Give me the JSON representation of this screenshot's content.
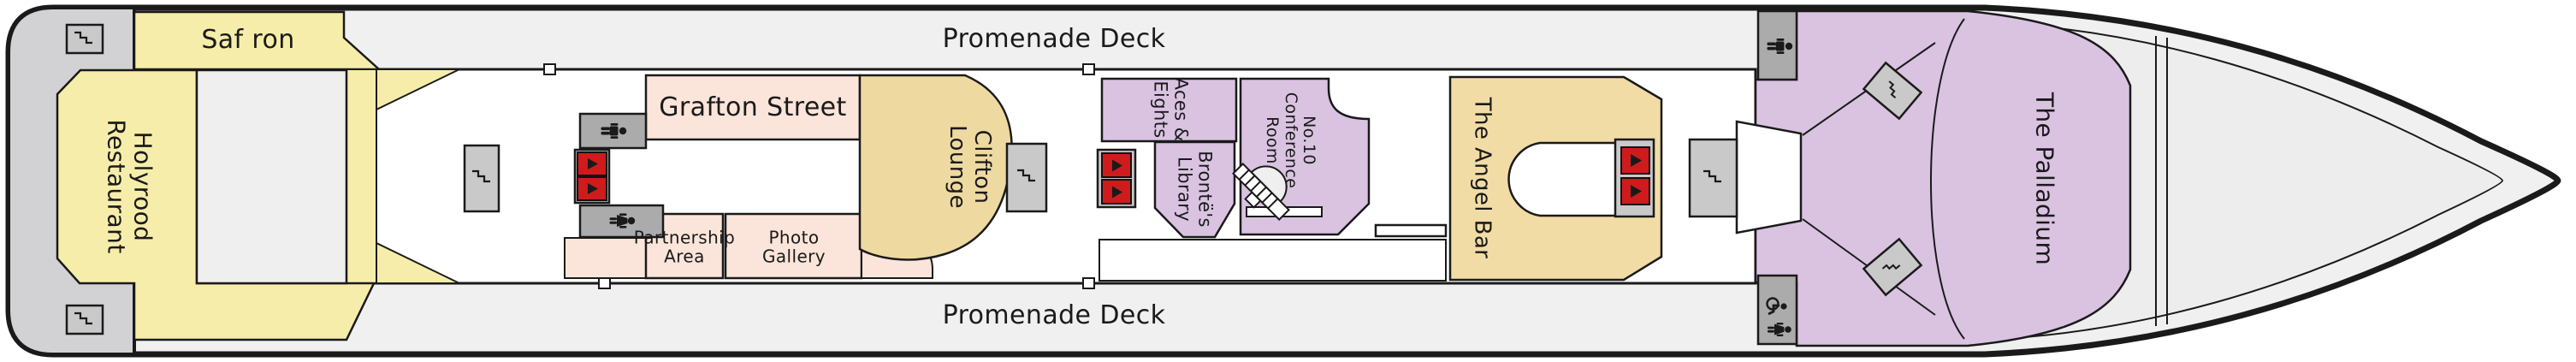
{
  "deck_plan": {
    "promenade_deck_top": "Promenade Deck",
    "promenade_deck_bottom": "Promenade Deck",
    "rooms": {
      "saffron": {
        "label": "Saf ron",
        "color": "#f6edaa"
      },
      "holyrood_restaurant": {
        "label": "Holyrood\nRestaurant",
        "color": "#f6edaa"
      },
      "grafton_street": {
        "label": "Grafton Street",
        "color": "#fbe4d9"
      },
      "partnership_area": {
        "label": "Partnership\nArea",
        "color": "#fbe4d9"
      },
      "photo_gallery": {
        "label": "Photo\nGallery",
        "color": "#fbe4d9"
      },
      "clifton_lounge": {
        "label": "Clifton\nLounge",
        "color": "#eed9a1"
      },
      "aces_and_eights": {
        "label": "Aces &\nEights",
        "color": "#d9c3e1"
      },
      "brontes_library": {
        "label": "Brontë's\nLibrary",
        "color": "#d9c3e1"
      },
      "no10_conference_room": {
        "label": "No.10\nConference\nRoom",
        "color": "#d9c3e1"
      },
      "the_angel_bar": {
        "label": "The Angel Bar",
        "color": "#f2dca6"
      },
      "the_palladium": {
        "label": "The Palladium",
        "color": "#d9c3e1"
      }
    },
    "icons": [
      "stairs-icon",
      "elevator-icon",
      "mens-restroom-icon",
      "womens-restroom-icon",
      "accessible-restroom-icon",
      "grand-staircase-icon"
    ],
    "colors": {
      "hull_deck": "#f0f0f1",
      "stern_block": "#d2d2d4",
      "walls": "#1a1a1a",
      "stairs_box": "#c9c9ca",
      "restroom_box": "#ababac",
      "elevator_red": "#cf1b1c",
      "yellow_rooms": "#f6edaa",
      "pink_rooms": "#fbe4d9",
      "tan_rooms": "#eed9a1",
      "purple_rooms": "#d9c3e1"
    }
  }
}
